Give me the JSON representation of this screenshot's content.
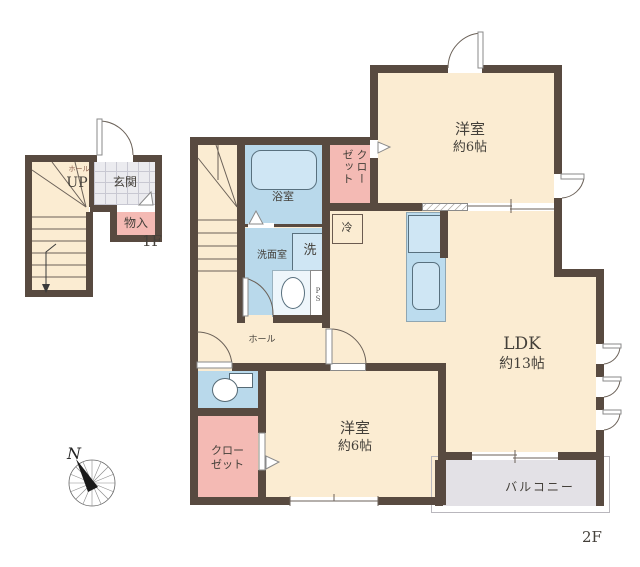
{
  "title": "floor-plan",
  "labels": {
    "f1_hall": "ホール",
    "f1_up": "UP",
    "f1_entrance": "玄関",
    "f1_storage": "物入",
    "f1_floor": "1F",
    "f2_bath": "浴室",
    "f2_washroom": "洗面室",
    "f2_washer": "洗",
    "f2_closet_upper": "クローゼット",
    "f2_fridge": "冷",
    "f2_ps": "PS",
    "f2_bedroom_top_name": "洋室",
    "f2_bedroom_top_size": "約6帖",
    "f2_ldk_name": "LDK",
    "f2_ldk_size": "約13帖",
    "f2_hall": "ホール",
    "f2_closet_lower_line1": "クロー",
    "f2_closet_lower_line2": "ゼット",
    "f2_bedroom_bottom_name": "洋室",
    "f2_bedroom_bottom_size": "約6帖",
    "f2_balcony": "バルコニー",
    "f2_floor": "2F",
    "compass_north": "N"
  },
  "colors": {
    "wall": "#584a40",
    "floor": "#fbecd2",
    "wet_area": "#b9d9eb",
    "closet_pink": "#f4bab4",
    "balcony_gray": "#e3e1e6",
    "entrance_tile": "#ebebef"
  }
}
